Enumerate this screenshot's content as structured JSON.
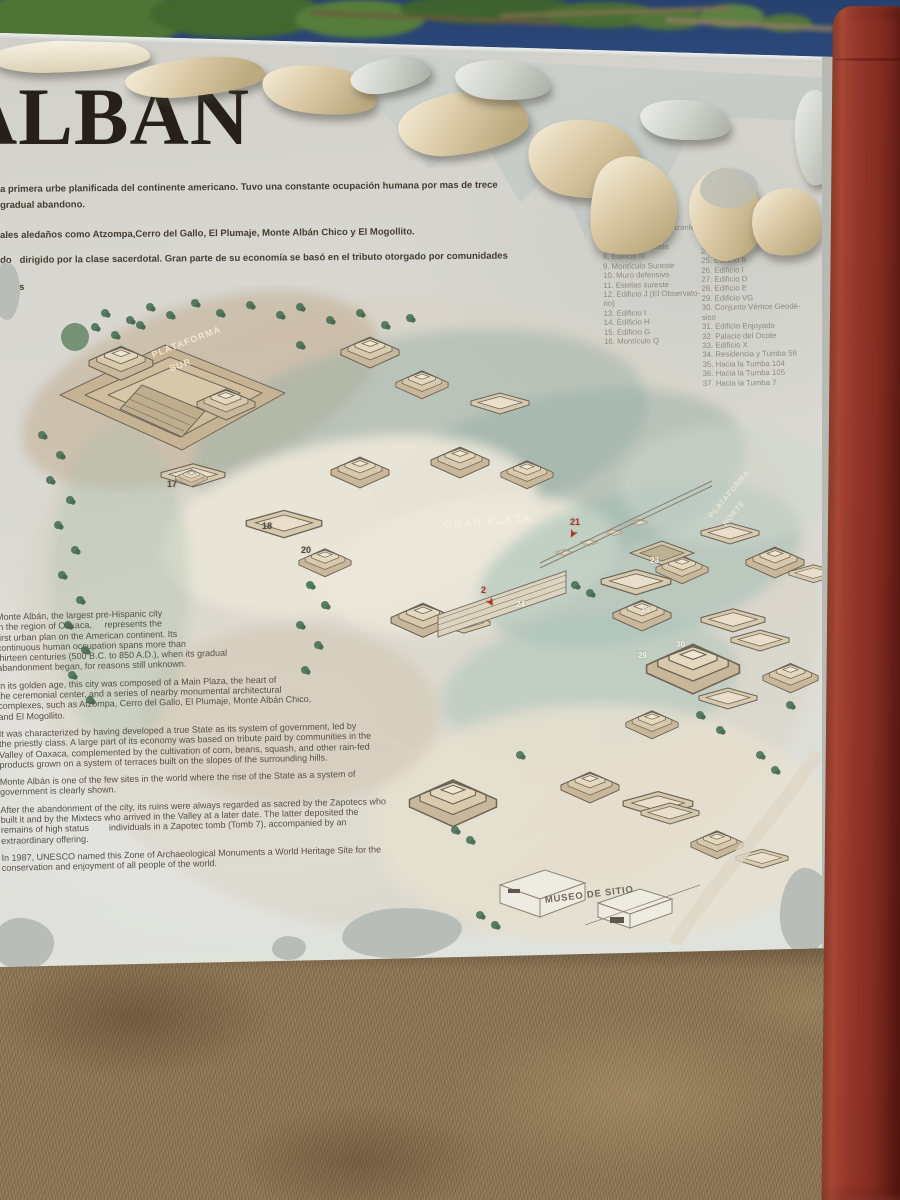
{
  "scene": {
    "sky_color": "#2e4c7e",
    "tree_color": "#4e7436",
    "ground_color": "#8d7555",
    "pole_color": "#8c3126",
    "sign_color": "#d8d7d1",
    "flap_color": "#dac9a5",
    "peel_color": "#c2c6c2"
  },
  "sign": {
    "title": "ALBÁN",
    "title_color": "#262019",
    "intro_lines": [
      "a primera urbe planificada del continente americano. Tuvo una constante ocupación humana por mas de trece",
      "gradual abandono.",
      "ales aledaños como Atzompa,Cerro del Gallo, El Plumaje, Monte Albán Chico y El Mogollito.",
      "do   dirigido por la clase sacerdotal. Gran parte de su economía se basó en el tributo otorgado por comunidades",
      "razas",
      "el"
    ],
    "legend": {
      "col1": [
        {
          "t": "cio K",
          "x": 34
        },
        {
          "t": "o de los Dan-",
          "x": 12
        },
        {
          "t": "antes"
        },
        {
          "t": "5. Galería de los Danzantes"
        },
        {
          "t": "6. Sistema M"
        },
        {
          "t": "7. Estelas suroeste"
        },
        {
          "t": "8. Edificio III"
        },
        {
          "t": "9. Montículo Sureste"
        },
        {
          "t": "10. Muro defensivo"
        },
        {
          "t": "11. Estelas sureste"
        },
        {
          "t": "12. Edificio J (El Observato-"
        },
        {
          "t": "rio)"
        },
        {
          "t": "13. Edificio I"
        },
        {
          "t": "14. Edificio H"
        },
        {
          "t": "15. Edificio G"
        },
        {
          "t": "16. Montículo Q"
        }
      ],
      "col2": [
        {
          "t": "17. El Palacio"
        },
        {
          "t": "18. Edificio P"
        },
        {
          "t": "19. Adoratorio"
        },
        {
          "t": "20. Edificio"
        },
        {
          "t": "21. Estela"
        },
        {
          "t": "22. Pórtico"
        },
        {
          "t": "23. Patio Hundido"
        },
        {
          "t": "24. Edificio A"
        },
        {
          "t": "25. Edificio B"
        },
        {
          "t": "26. Edificio I"
        },
        {
          "t": "27. Edificio D"
        },
        {
          "t": "28. Edificio E"
        },
        {
          "t": "29. Edificio VG"
        },
        {
          "t": "30. Conjunto Vértice Geodé-"
        },
        {
          "t": "sico"
        },
        {
          "t": "31. Edificio Enjoyado"
        },
        {
          "t": "32. Palacio del Ocote"
        },
        {
          "t": "33. Edificio X"
        },
        {
          "t": "34. Residencia y Tumba 56"
        },
        {
          "t": "35. Hacia la Tumba 104"
        },
        {
          "t": "36. Hacia la Tumba 105"
        },
        {
          "t": "37. Hacia la Tumba 7"
        }
      ]
    },
    "body": {
      "p1": [
        "Monte Albán, the largest pre-Hispanic city",
        "in the region of Oaxaca,     represents the",
        "first urban plan on the American continent. Its",
        "continuous human occupation spans more than",
        "thirteen centuries (500 B.C. to 850 A.D.), when its gradual",
        "abandonment began, for reasons still unknown."
      ],
      "p2": [
        "In its golden age, this city was composed of a Main Plaza, the heart of",
        "the ceremonial center, and a series of nearby monumental architectural",
        "complexes, such as Atzompa, Cerro del Gallo, El Plumaje, Monte Albán Chico,",
        "and El Mogollito."
      ],
      "p3": [
        "It was characterized by having developed a true State as its system of government, led by",
        "the priestly class. A large part of its economy was based on tribute paid by communities in the",
        "Valley of Oaxaca, complemented by the cultivation of corn, beans, squash, and other rain-fed",
        "products grown on a system of terraces built on the slopes of the surrounding hills."
      ],
      "p4": [
        "Monte Albán is one of the few sites in the world where the rise of the State as a system of",
        "government is clearly shown."
      ],
      "p5": [
        "After the abandonment of the city, its ruins were always regarded as sacred by the Zapotecs who",
        "built it and by the Mixtecs who arrived in the Valley at a later date. The latter deposited the",
        "remains of high status        individuals in a Zapotec tomb (Tomb 7), accompanied by an",
        "extraordinary offering."
      ],
      "p6": [
        "In 1987, UNESCO named this Zone of Archaeological Monuments a World Heritage Site for the",
        "conservation and enjoyment of all people of the world."
      ]
    },
    "map": {
      "labels": [
        {
          "t": "PLATAFORMA",
          "x": 152,
          "y": 350,
          "rot": -21,
          "size": 9,
          "c": "#f0e6cd",
          "ls": 1.2
        },
        {
          "t": "SUR",
          "x": 170,
          "y": 364,
          "rot": -21,
          "size": 9,
          "c": "#f0e6cd",
          "ls": 1.2
        },
        {
          "t": "GRAN PLAZA",
          "x": 444,
          "y": 519,
          "rot": -4,
          "size": 10.5,
          "c": "#f3efe2",
          "ls": 2
        },
        {
          "t": "PLATAFORMA",
          "x": 710,
          "y": 512,
          "rot": -50,
          "size": 7.5,
          "c": "#e9e4d4",
          "ls": 0.8
        },
        {
          "t": "NORTE",
          "x": 724,
          "y": 520,
          "rot": -50,
          "size": 7.5,
          "c": "#e9e4d4",
          "ls": 0.8
        },
        {
          "t": "MUSEO DE SITIO",
          "x": 545,
          "y": 895,
          "rot": -7,
          "size": 9.5,
          "c": "#6d675c",
          "ls": 0.8
        }
      ],
      "markers": [
        {
          "t": "17",
          "x": 167,
          "y": 479,
          "c": "#4f493f"
        },
        {
          "t": "18",
          "x": 262,
          "y": 521,
          "c": "#4f493f"
        },
        {
          "t": "20",
          "x": 301,
          "y": 545,
          "c": "#4f493f"
        },
        {
          "t": "21",
          "x": 570,
          "y": 517,
          "c": "#b03227"
        },
        {
          "t": "➤",
          "x": 568,
          "y": 528,
          "c": "#b03227",
          "rot": 118,
          "size": 10
        },
        {
          "t": "2",
          "x": 481,
          "y": 585,
          "c": "#b03227"
        },
        {
          "t": "➤",
          "x": 486,
          "y": 597,
          "c": "#b03227",
          "rot": 60,
          "size": 10
        },
        {
          "t": "23",
          "x": 650,
          "y": 556,
          "c": "#f2efe3",
          "size": 8
        },
        {
          "t": "24",
          "x": 516,
          "y": 600,
          "c": "#f2efe3",
          "size": 8
        },
        {
          "t": "28",
          "x": 641,
          "y": 605,
          "c": "#f2efe3",
          "size": 8
        },
        {
          "t": "29",
          "x": 638,
          "y": 651,
          "c": "#f2efe3",
          "size": 8
        },
        {
          "t": "30",
          "x": 676,
          "y": 640,
          "c": "#f2efe3",
          "size": 8
        }
      ],
      "accent_red": "#b03227",
      "wash_teal": "#9dbcb2",
      "wash_tan": "#c6b394"
    }
  }
}
